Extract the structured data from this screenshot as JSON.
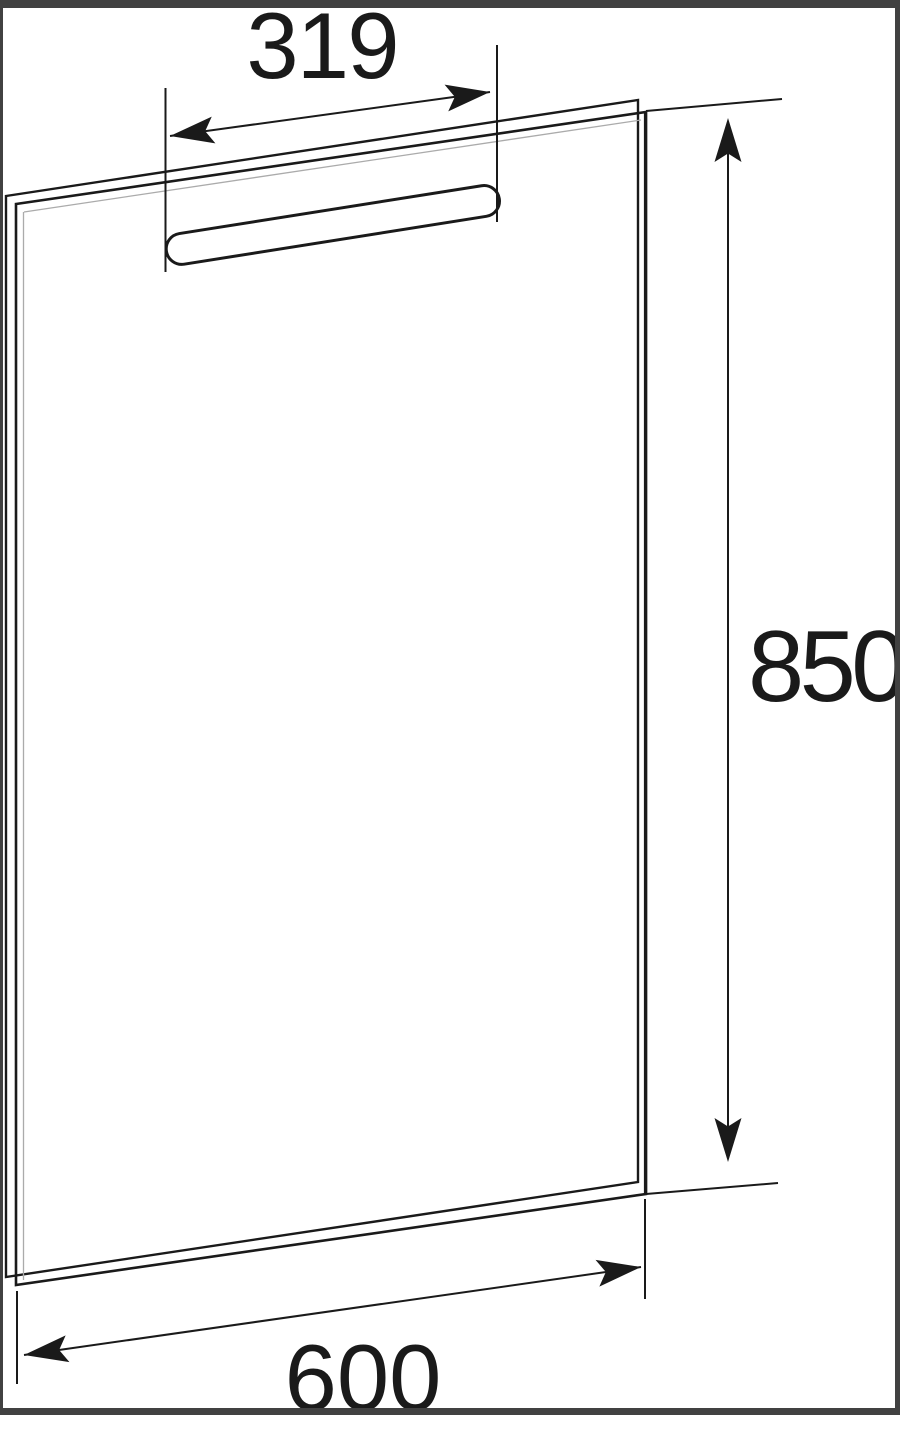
{
  "diagram": {
    "kind": "technical dimension drawing",
    "subject": "rectangular mirror panel with integrated light bar",
    "labels": {
      "light_bar_width": "319",
      "panel_height": "850",
      "panel_width": "600"
    },
    "colors": {
      "background": "#ffffff",
      "line": "#1a1a1a",
      "frame": "#414141"
    }
  }
}
